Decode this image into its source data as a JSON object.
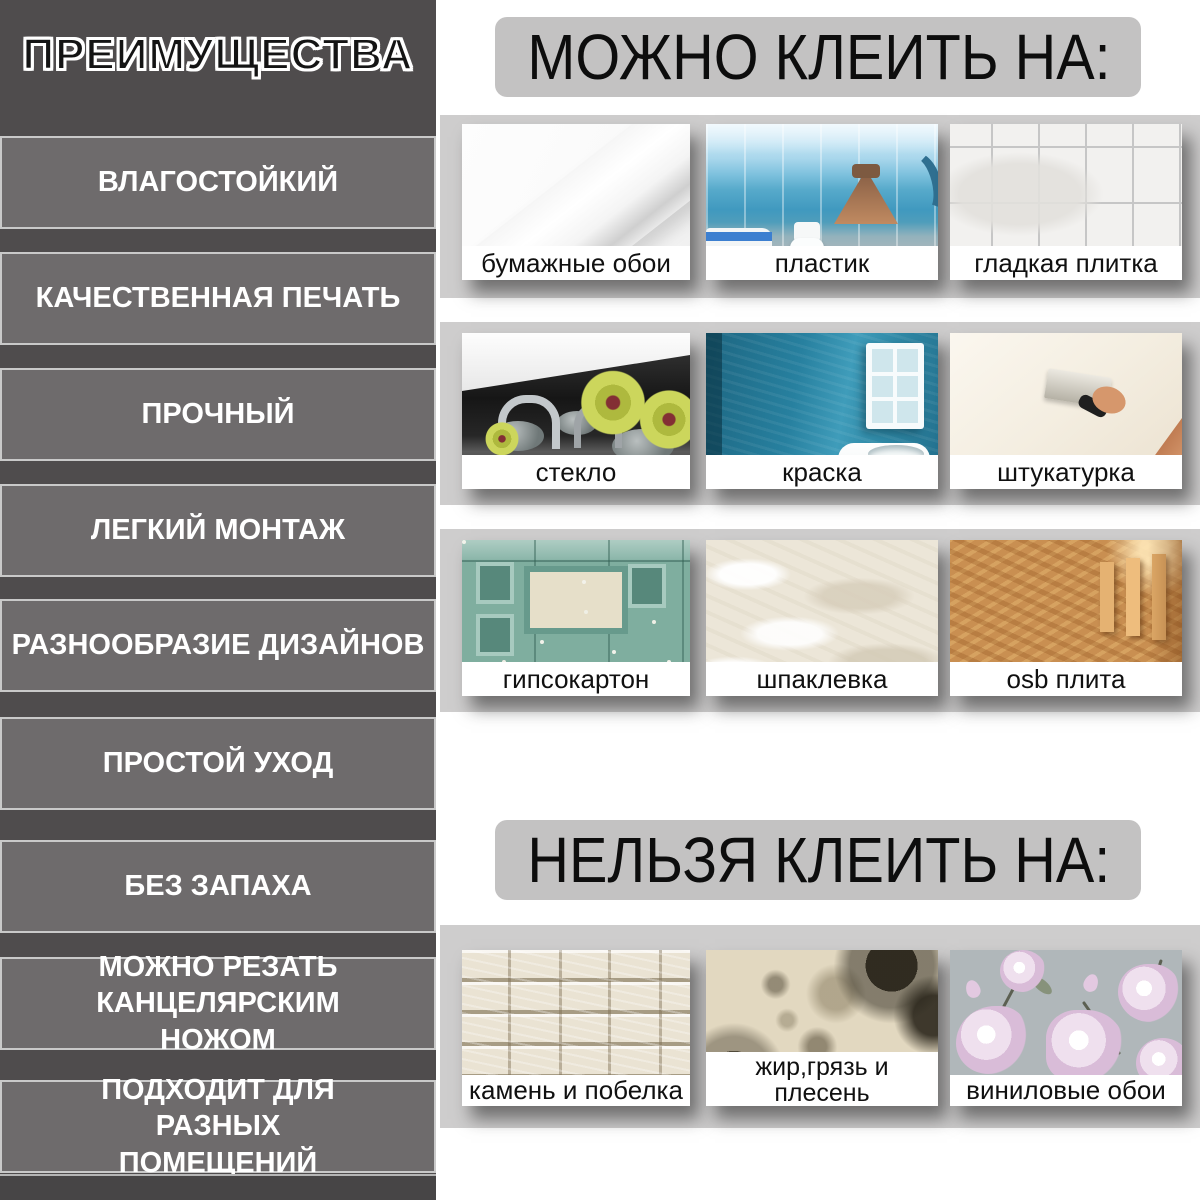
{
  "sidebar": {
    "title": "ПРЕИМУЩЕСТВА",
    "items": [
      "ВЛАГОСТОЙКИЙ",
      "КАЧЕСТВЕННАЯ ПЕЧАТЬ",
      "ПРОЧНЫЙ",
      "ЛЕГКИЙ МОНТАЖ",
      "РАЗНООБРАЗИЕ ДИЗАЙНОВ",
      "ПРОСТОЙ УХОД",
      "БЕЗ ЗАПАХА",
      "МОЖНО РЕЗАТЬ КАНЦЕЛЯРСКИМ НОЖОМ",
      "ПОДХОДИТ ДЛЯ РАЗНЫХ ПОМЕЩЕНИЙ"
    ]
  },
  "can_section": {
    "header": "МОЖНО КЛЕИТЬ НА:",
    "rows": [
      [
        "бумажные обои",
        "пластик",
        "гладкая плитка"
      ],
      [
        "стекло",
        "краска",
        "штукатурка"
      ],
      [
        "гипсокартон",
        "шпаклевка",
        "osb плита"
      ]
    ]
  },
  "cannot_section": {
    "header": "НЕЛЬЗЯ КЛЕИТЬ НА:",
    "items": [
      "камень и побелка",
      "жир,грязь и плесень",
      "виниловые обои"
    ]
  },
  "colors": {
    "sidebar_bg": "#4f4c4d",
    "advantage_bar_bg": "#6e6b6c",
    "advantage_bar_border": "#c9c9c9",
    "band_bg": "#cecdcd",
    "header_box_bg": "#c3c2c2",
    "caption_bg": "#ffffff",
    "text_light": "#ffffff",
    "text_dark": "#111111"
  }
}
